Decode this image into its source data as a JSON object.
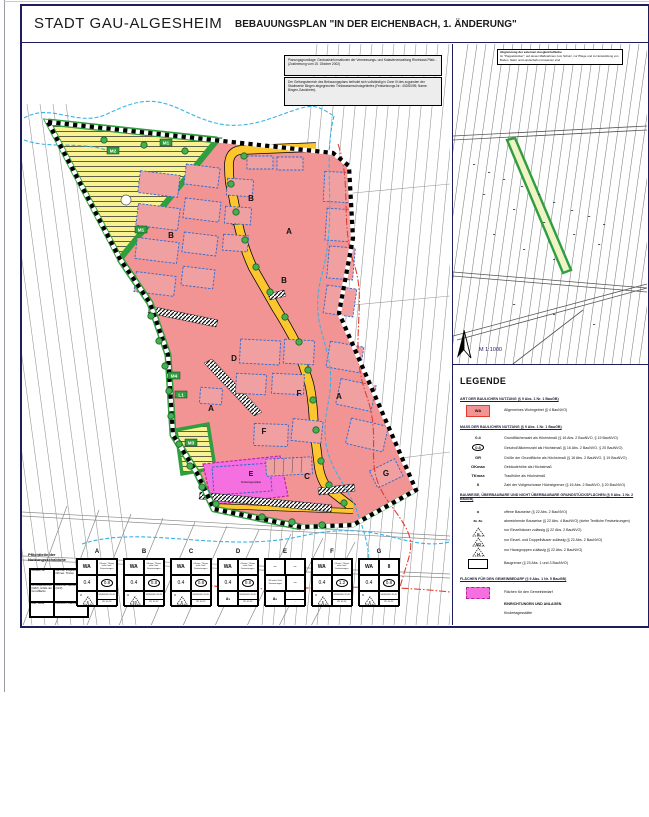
{
  "header": {
    "title": "STADT GAU-ALGESHEIM",
    "subtitle": "BEBAUUNGSPLAN  \"IN DER EICHENBACH, 1. ÄNDERUNG\""
  },
  "notes": {
    "basis": "Planungsgrundlage: Geobasisinformationen der Vermessungs- und Katasterverwaltung Rheinland-Pfalz - (Zustimmung vom 15. Oktober 2002)",
    "schutz": "Der Geltungsbereich des Bebauungsplans befindet sich vollständig in Zone III des zugunsten der Stadtwerke Bingen abgegrenzten Trinkwasserschutzgebietes (Festsetzungs-Nr.: 402/80/95; Name: Bingen-Gaulsheim).",
    "ausgleich_title": "Abgrenzung der externen Ausgleichsfläche",
    "ausgleich_text": "Im \"Pappelstücker\", auf denen Maßnahmen zum Schutz, zur Pflege und zur Entwicklung von Boden, Natur und Landschaft umzusetzen sind"
  },
  "inset": {
    "scale": "M 1:1000"
  },
  "map": {
    "za": "A",
    "zb": "B",
    "zc": "C",
    "zd": "D",
    "ze": "E",
    "zf": "F",
    "zg": "G",
    "m1": "M1",
    "m2": "M2",
    "m3": "M3",
    "m4": "M4",
    "l1": "L1",
    "kita": "Kindertagesstätte"
  },
  "legend": {
    "title": "LEGENDE",
    "s1_head": "ART DER BAULICHEN NUTZUNG (§ 9 Abs. 1 Nr. 1 BauGB)",
    "wa_sym": "WA",
    "wa": "Allgemeines Wohngebiet (§ 4 BauNVO)",
    "s2_head": "MASS DER BAULICHEN NUTZUNG (§ 9 Abs. 1 Nr. 1 BauGB)",
    "grz_sym": "0.4",
    "grz": "Grundflächenzahl als Höchstmaß (§ 16 Abs. 2 BauNVO, § 19 BauNVO)",
    "gfz_sym": "0.8",
    "gfz": "Geschoßflächenzahl als Höchstmaß (§ 16 Abs. 2 BauNVO, § 20 BauNVO)",
    "gr_sym": "GR",
    "gr": "Größe der Grundfläche als Höchstmaß (§ 16 Abs. 2 BauNVO, § 19 BauNVO)",
    "ok_sym": "OKmax",
    "ok": "Gebäudehöhe als Höchstmaß",
    "tk_sym": "TKmax",
    "tk": "Traufhöhe als Höchstmaß",
    "vg_sym": "II",
    "vg": "Zahl der Vollgeschosse Höchstgrenze (§ 16 Abs. 2 BauNVO, § 20 BauNVO)",
    "s3_head": "BAUWEISE, ÜBERBAUBARE UND NICHT ÜBERBAUBARE GRUNDSTÜCKSFLÄCHEN (§ 9 Abs. 1 Nr. 2 BauGB)",
    "o_sym": "o",
    "o": "offene Bauweise (§ 22 Abs. 2 BauNVO)",
    "ab_sym": "a₁  a₂",
    "ab": "abweichende Bauweise (§ 22 Abs. 4 BauNVO) (siehe Textliche Festsetzungen)",
    "e_sym": "E",
    "e": "nur Einzelhäuser zulässig (§ 22 Abs. 2 BauNVO)",
    "ed_sym": "ED",
    "ed": "nur Einzel- und Doppelhäuser zulässig (§ 22 Abs. 2 BauNVO)",
    "h_sym": "H",
    "h": "nur Hausgruppen zulässig (§ 22 Abs. 2 BauNVO)",
    "bg": "Baugrenze (§ 23 Abs. 1 und 3 BauNVO)",
    "s4_head": "FLÄCHEN FÜR DEN GEMEINBEDARF (§ 9 Abs. 1 Nr. 5 BauGB)",
    "gb": "Flächen für den Gemeinbedarf",
    "gb2": "EINRICHTUNGEN UND ANLAGEN",
    "gb3": "Kindertagesstätte"
  },
  "table": {
    "heading": "Pflichtteile der Nutzungsschablone",
    "key": {
      "r1c1": "Gebiets- art",
      "r1c2": "Zahl der Vollgeschosse, OKmax, TKmax",
      "r2c1": "Grundflächenzahl (GRZ), Größe der Grundfläche",
      "r2c2": "Geschoß- flächenzahl (GFZ)",
      "r3c1": "Bau- weise",
      "r3c2": "Dachform, Dachneigung"
    },
    "columns": [
      {
        "label": "A",
        "area": "WA",
        "top": "OKmax / TKmax siehe Textl. Festsetzungen",
        "grz": "0.4",
        "gfz": "0.8",
        "bau": "o",
        "haus": "E",
        "dach1": "SD/WD/KD 28-45°",
        "dach2": "PD 10-15°"
      },
      {
        "label": "B",
        "area": "WA",
        "top": "OKmax / TKmax siehe Textl. Festsetzungen",
        "grz": "0.4",
        "gfz": "0.8",
        "bau": "o",
        "haus": "ED",
        "dach1": "SD/WD/KD 28-45°",
        "dach2": "PD 10-15°"
      },
      {
        "label": "C",
        "area": "WA",
        "top": "OKmax / TKmax siehe Textl. Festsetzungen",
        "grz": "0.4",
        "gfz": "0.8",
        "bau": "o",
        "haus": "E",
        "dach1": "SD/WD/KD 28-45°",
        "dach2": "PD 10-15°"
      },
      {
        "label": "D",
        "area": "WA",
        "top": "OKmax / TKmax siehe Textl. Festsetzungen",
        "grz": "0.4",
        "gfz": "0.8",
        "bau": "a₁",
        "haus": "",
        "dach1": "SD/WD/KD 28-45°",
        "dach2": "PD 10-15°"
      },
      {
        "label": "E",
        "area": "–",
        "top": "–",
        "grz": "GR siehe Textl. Festsetzungen",
        "gfz": "–",
        "bau": "a₂",
        "haus": "",
        "dach1": "–",
        "dach2": "–"
      },
      {
        "label": "F",
        "area": "WA",
        "top": "OKmax / TKmax siehe Textl. Festsetzungen",
        "grz": "0.4",
        "gfz": "1.2",
        "bau": "o",
        "haus": "E",
        "dach1": "SD/WD/KD 28-45°",
        "dach2": "PD 10-15°"
      },
      {
        "label": "G",
        "area": "WA",
        "top": "II",
        "grz": "0.4",
        "gfz": "0.8",
        "bau": "o",
        "haus": "E",
        "dach1": "SD/WD/KD 28-45°",
        "dach2": "PD 10-15°"
      }
    ]
  },
  "colors": {
    "wa_pink": "#f29394",
    "gemeinbedarf_magenta": "#f56fe0",
    "road_yellow": "#fdc62f",
    "greening": "#2f9e3f",
    "hatch_yellow": "#f8f290",
    "water_blue": "#35b4e8",
    "boundary_red": "#e23b2e",
    "frame_navy": "#1d1d5e"
  }
}
